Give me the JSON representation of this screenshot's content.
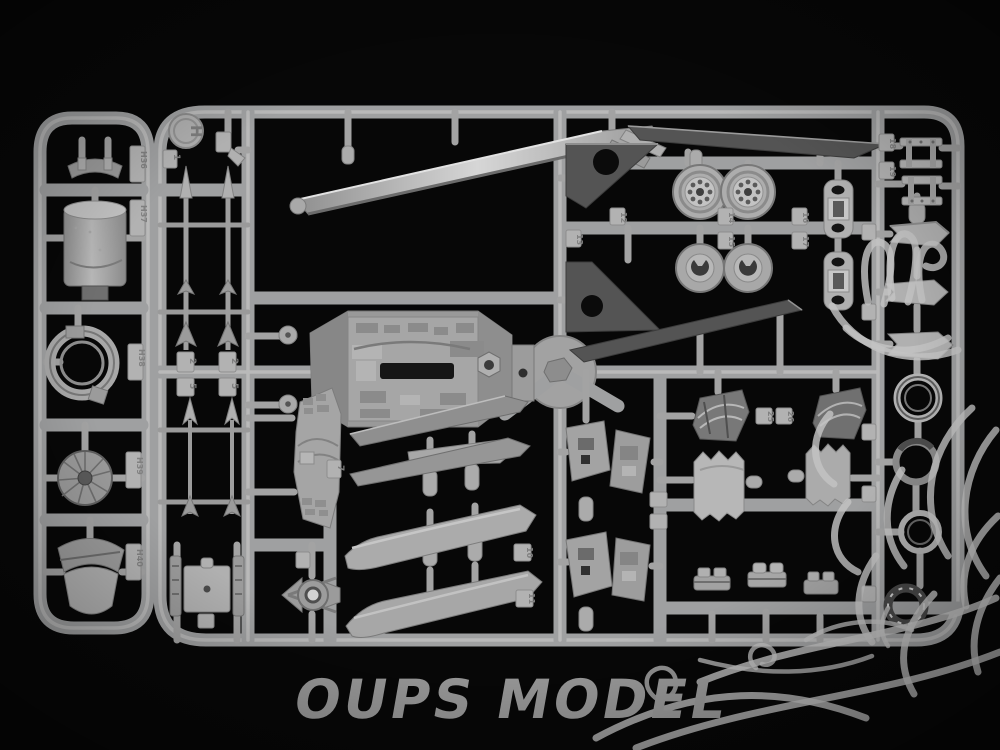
{
  "scene": {
    "type": "product-photo",
    "subject": "Gray injection-molded plastic model kit sprue (runner) with aircraft parts photographed on a black background",
    "background_color": "#070707",
    "plastic_color": "#b0b0b0",
    "plastic_shadow_color": "#6a6a6a",
    "dark_part_color": "#565656"
  },
  "watermark": {
    "brand_text": "OUPS MODEL",
    "text_color": "#9c9c9c",
    "mascot": "cartoon-mascot-line-art",
    "line_color": "#c3c3c3"
  },
  "sprue": {
    "letter_stamp": "H",
    "left_runner_part_tags": [
      "H36",
      "H37",
      "H38",
      "H39",
      "H40"
    ],
    "part_number_tags": [
      "1",
      "2",
      "2",
      "5",
      "5",
      "7",
      "10",
      "11",
      "12",
      "13",
      "14",
      "15",
      "16",
      "17",
      "18",
      "19",
      "25",
      "26"
    ]
  },
  "part_tags": {
    "letter": "H",
    "h36": "H36",
    "h37": "H37",
    "h38": "H38",
    "h39": "H39",
    "h40": "H40",
    "n1": "1",
    "n2a": "2",
    "n2b": "2",
    "n5a": "5",
    "n5b": "5",
    "n7": "7",
    "n10": "10",
    "n11": "11",
    "n12": "12",
    "n13": "13",
    "n14": "14",
    "n15": "15",
    "n16": "16",
    "n17": "17",
    "n18": "18",
    "n19": "19",
    "n25": "25",
    "n26": "26"
  },
  "parts": [
    "support-brace",
    "fuel-drum",
    "clamp-ring",
    "engine-fan",
    "intake-lip",
    "missile-large",
    "missile-large",
    "missile-slim",
    "missile-slim",
    "cockpit-bay-tub",
    "leading-edge-blade",
    "dark-fin",
    "dark-fin",
    "dark-long-blade",
    "dark-long-blade",
    "spoked-wheel",
    "spoked-wheel",
    "wheel-hub",
    "wheel-hub",
    "hinge-bracket",
    "hinge-bracket",
    "ladder-frame",
    "ladder-frame",
    "armor-panel",
    "swivel-eye-mount",
    "gear-bay-bulkhead",
    "spine-fairing",
    "spine-fairing",
    "spine-fairing",
    "blade-fairing",
    "blade-fairing",
    "gear-door",
    "gear-door",
    "gear-door",
    "gear-door",
    "compressor-face",
    "compressor-face",
    "canvas-boot",
    "canvas-boot",
    "detail-block",
    "detail-block",
    "detail-block",
    "fin-tip-chevron",
    "fin-tip-chevron",
    "fin-tip-chevron",
    "nozzle-ring",
    "nozzle-ring",
    "nozzle-ring",
    "nozzle-ring",
    "sprue-hub"
  ]
}
